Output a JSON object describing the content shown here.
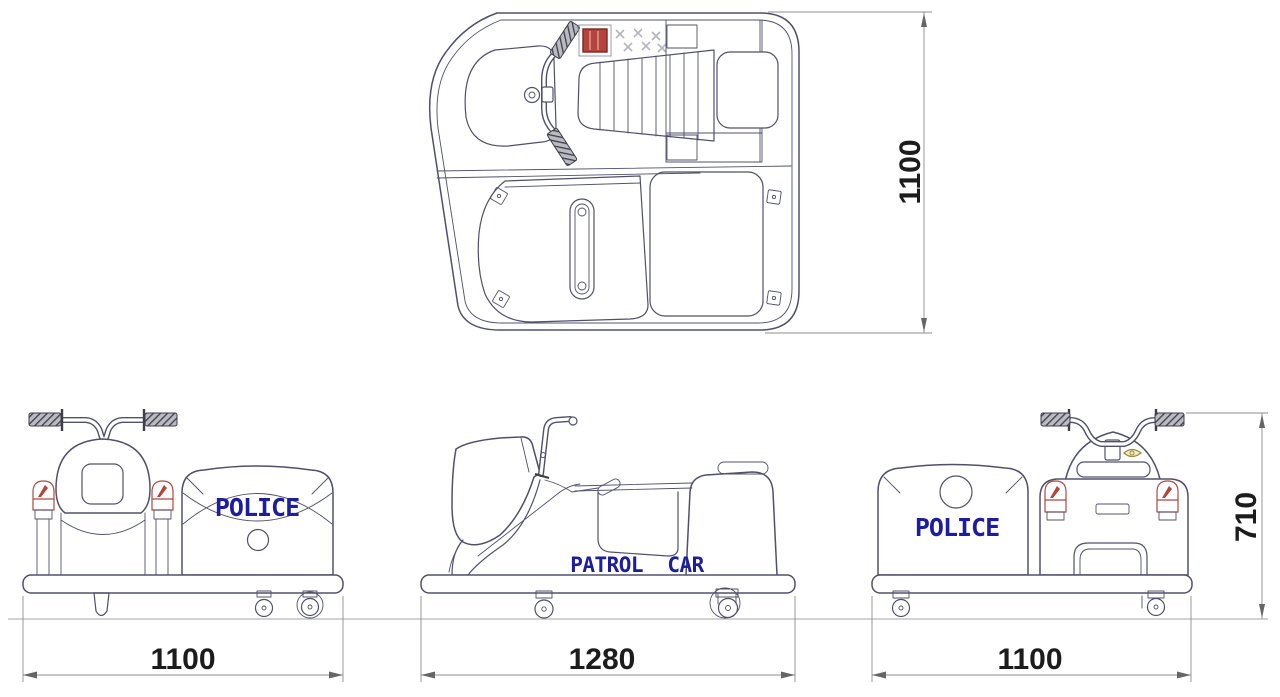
{
  "views": {
    "top": {
      "dim_depth": "1100"
    },
    "front": {
      "body_label": "POLICE",
      "dim_width": "1100"
    },
    "side": {
      "body_label": "PATROL  CAR",
      "dim_length": "1280"
    },
    "rear": {
      "body_label": "POLICE",
      "dim_width": "1100",
      "dim_height": "710"
    }
  },
  "colors": {
    "outline": "#50506e",
    "lettering_blue": "#1d1d9f",
    "accent_red": "#b5453c",
    "dimension_line": "#8f8f8f",
    "dimension_text": "#1c1c1c",
    "emblem_olive": "#9a8c3a"
  }
}
